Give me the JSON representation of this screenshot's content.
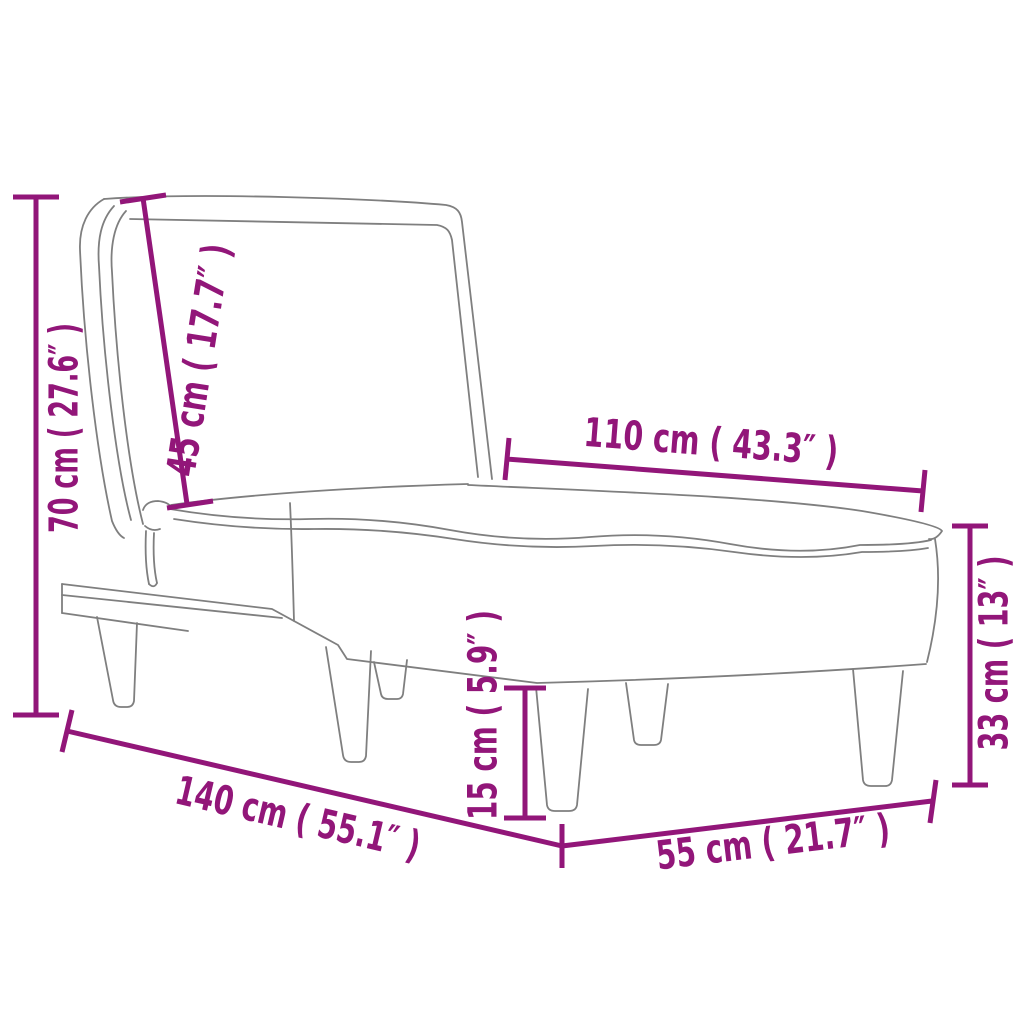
{
  "diagram": {
    "title": "chaise-longue-dimension-diagram",
    "colors": {
      "dimension": "#921679",
      "drawing": "#7f7f7f",
      "background": "#ffffff"
    },
    "dimensions": [
      {
        "id": "total-height",
        "label": "70 cm ( 27.6″ )"
      },
      {
        "id": "backrest-length",
        "label": "45 cm ( 17.7″ )"
      },
      {
        "id": "seat-length",
        "label": "110 cm ( 43.3″ )"
      },
      {
        "id": "seat-height",
        "label": "33 cm ( 13″ )"
      },
      {
        "id": "total-length",
        "label": "140 cm ( 55.1″ )"
      },
      {
        "id": "leg-height",
        "label": "15 cm ( 5.9″ )"
      },
      {
        "id": "total-width",
        "label": "55 cm ( 21.7″ )"
      }
    ]
  }
}
